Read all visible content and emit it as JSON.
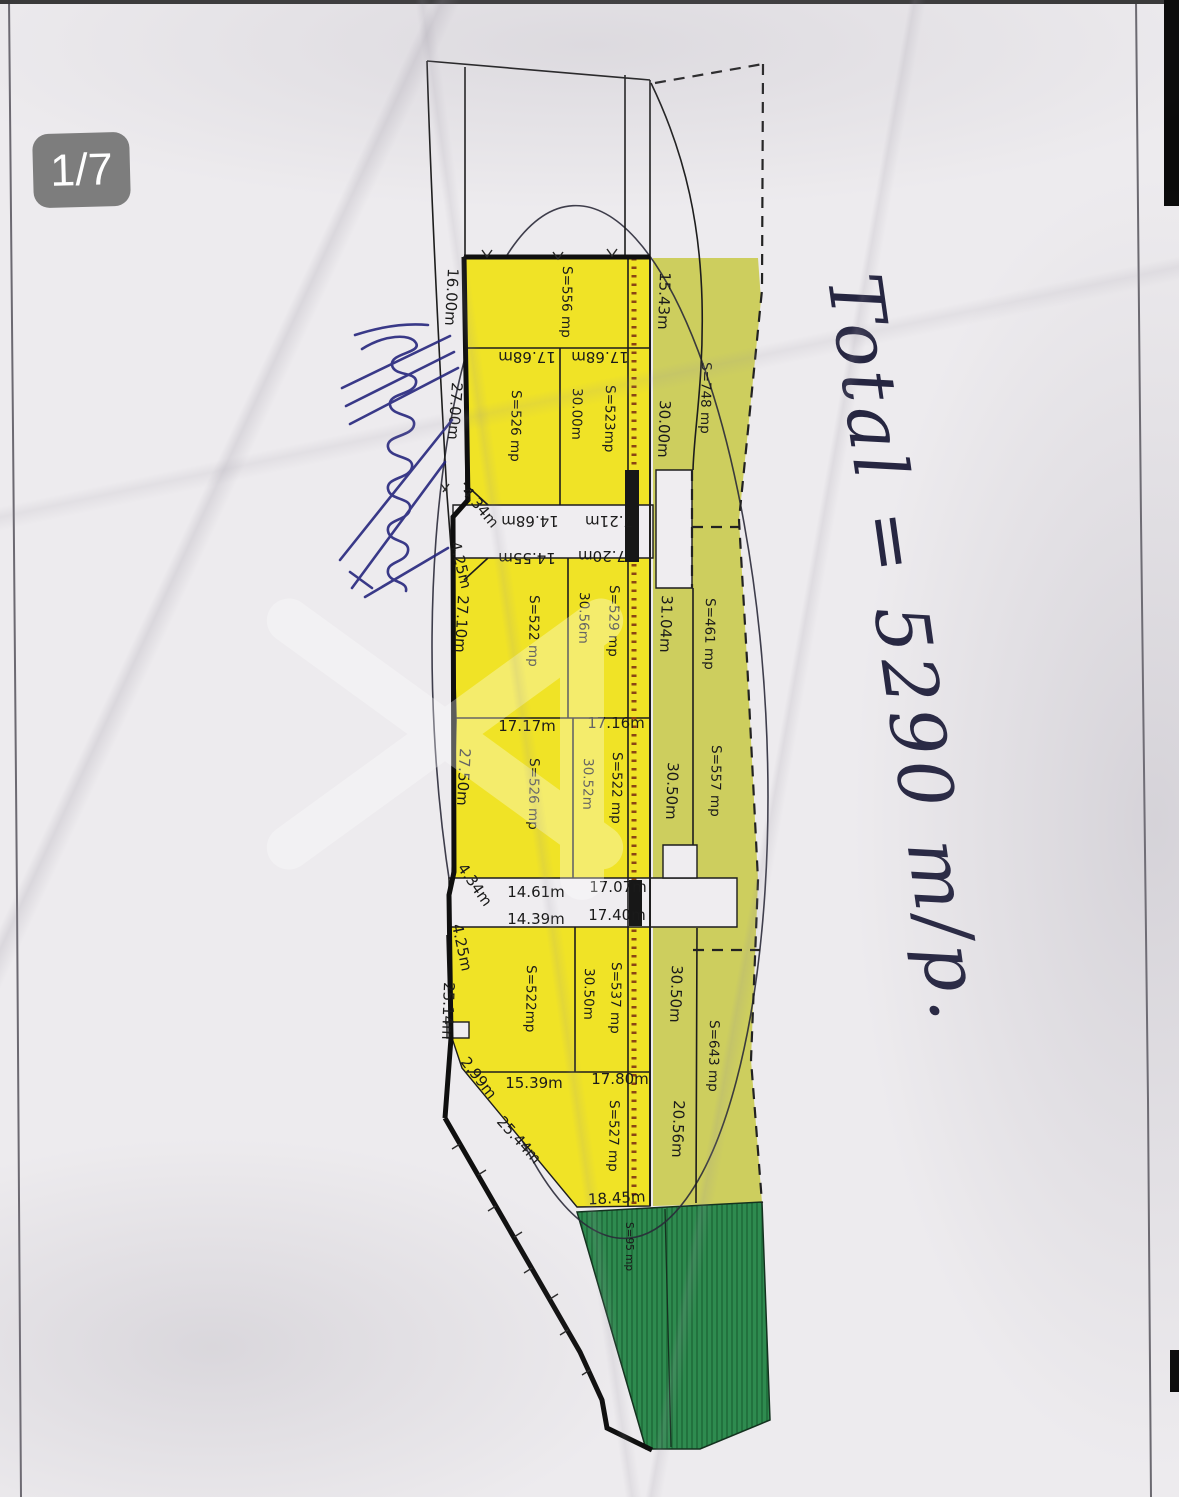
{
  "badge": {
    "label": "1/7"
  },
  "handwriting": {
    "text": "Total = 5290 m/p."
  },
  "plan": {
    "yellow_parcels": [
      "S=556 mp",
      "S=526 mp",
      "S=523mp",
      "S=522 mp",
      "S=529 mp",
      "S=526 mp",
      "S=522 mp",
      "S=522mp",
      "S=537 mp",
      "S=527 mp"
    ],
    "olive_parcels": [
      "S=748 mp",
      "S=461 mp",
      "S=557 mp",
      "S=643 mp"
    ],
    "green_parcel": "S=95 mp",
    "left_boundary": [
      "16.00m",
      "27.00m",
      "4.34m",
      "4.25m",
      "27.10m",
      "27.50m",
      "4.34m",
      "4.25m",
      "25.14m",
      "2.99m",
      "25.44m"
    ],
    "right_column": [
      "15.43m",
      "30.00m",
      "31.04m",
      "30.50m",
      "30.50m",
      "20.56m"
    ],
    "inner_vertical": [
      "30.00m",
      "30.56m",
      "30.52m",
      "30.50m"
    ],
    "flipped": [
      "17.68m",
      "17.68m",
      "14.68m",
      "7.21m",
      "14.55m",
      "7.20m"
    ],
    "horizontal": [
      "17.17m",
      "17.16m",
      "14.61m",
      "17.07m",
      "14.39m",
      "17.40m",
      "15.39m",
      "17.80m",
      "18.45m"
    ]
  }
}
